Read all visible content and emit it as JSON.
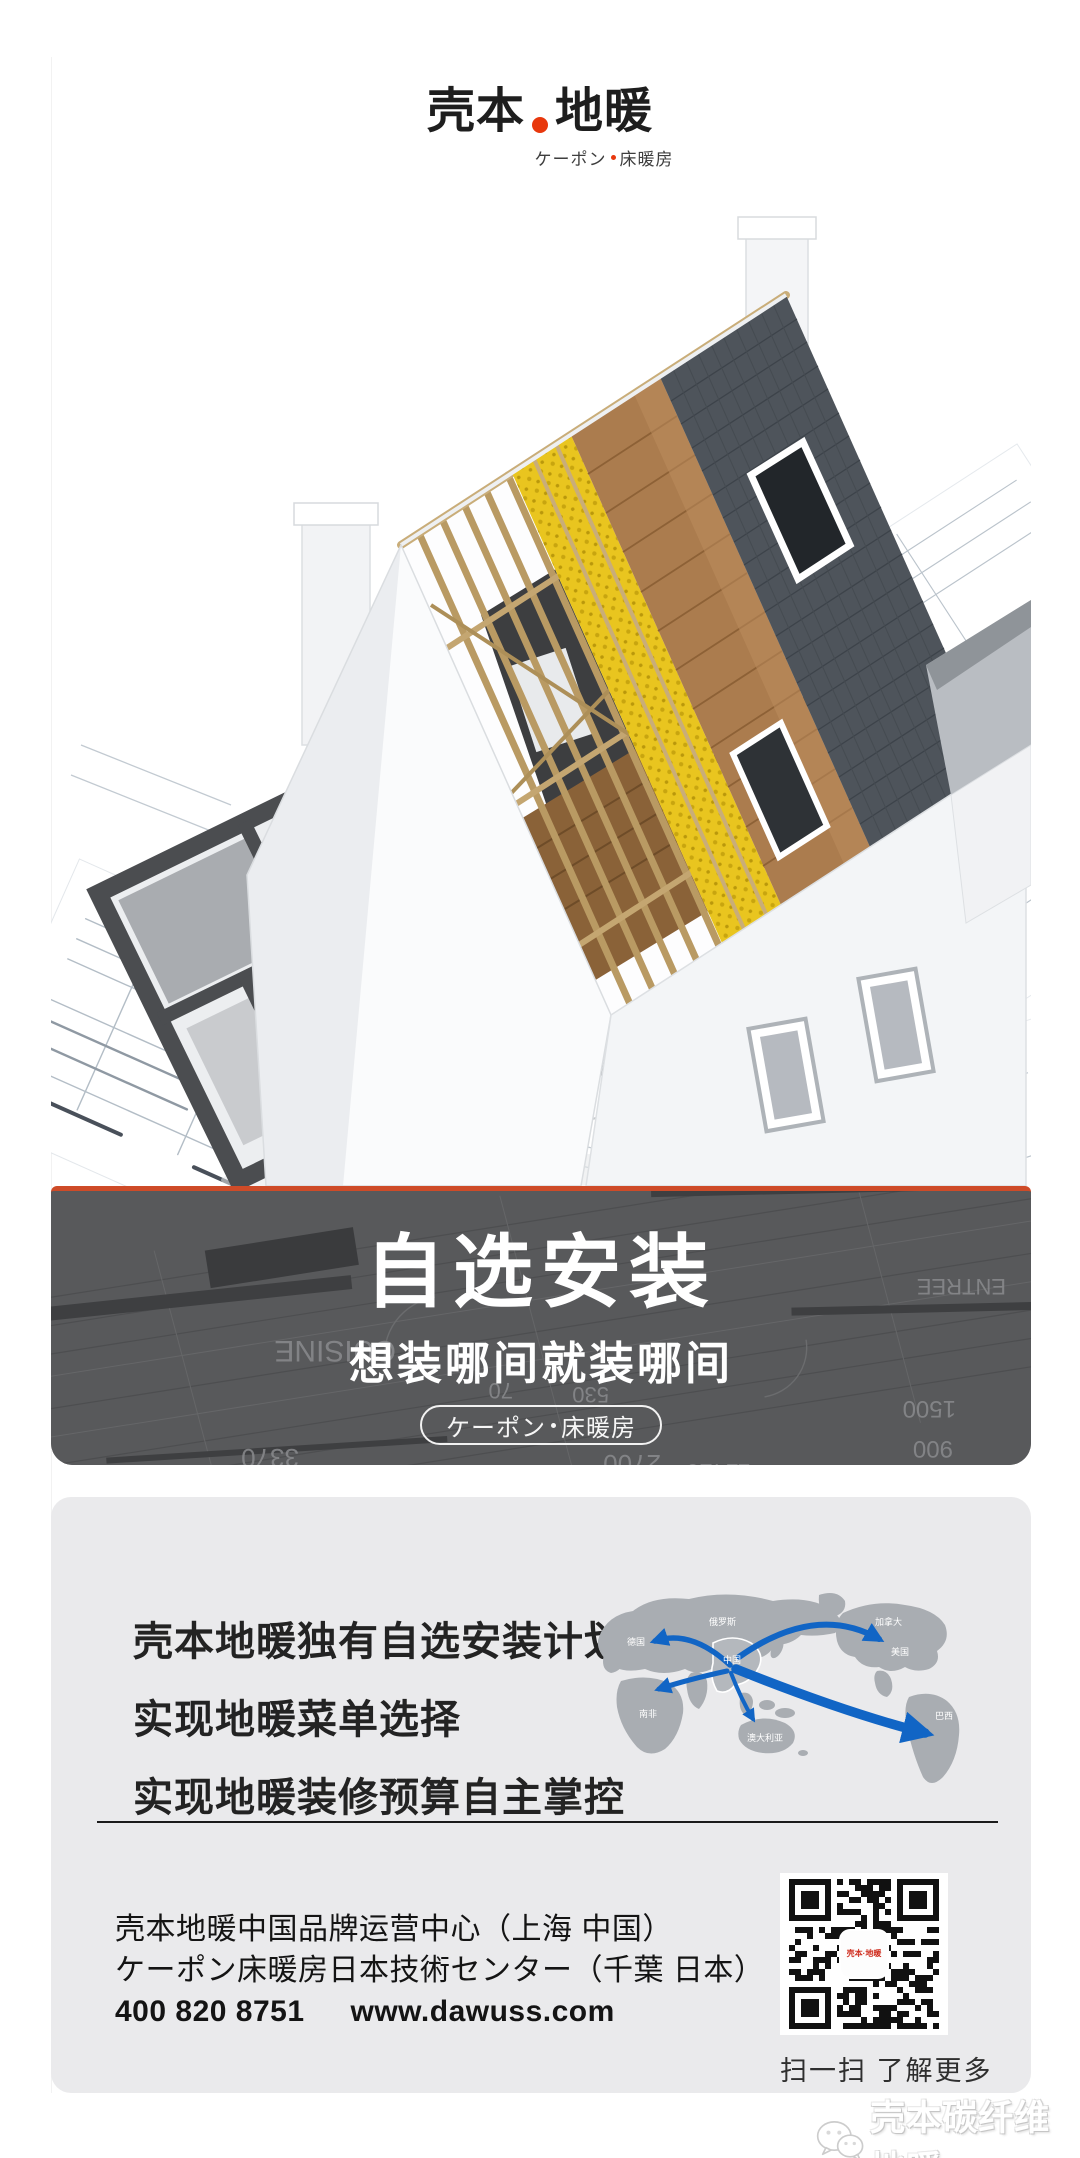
{
  "logo": {
    "title_left": "壳本",
    "title_right": "地暖",
    "subtitle_left": "ケーポン",
    "subtitle_right": "床暖房",
    "accent_color": "#e8380d"
  },
  "banner": {
    "title": "自选安装",
    "subtitle": "想装哪间就装哪间",
    "badge_left": "ケーポン",
    "badge_right": "床暖房",
    "accent_color": "#ce4b28",
    "bg_color": "#58595b",
    "blueprint_words": [
      "CUISINE",
      "ENTREE"
    ],
    "blueprint_numbers": [
      "3370",
      "2700",
      "11420",
      "1500",
      "900",
      "530",
      "70"
    ]
  },
  "hero": {
    "blueprint_words": [
      "TOILET"
    ]
  },
  "info_card": {
    "line1": "壳本地暖独有自选安装计划，",
    "line2": "实现地暖菜单选择",
    "line3": "实现地暖装修预算自主掌控",
    "map": {
      "land_color": "#a9adb2",
      "arrow_color": "#1165c5",
      "labels": [
        {
          "text": "俄罗斯"
        },
        {
          "text": "德国"
        },
        {
          "text": "中国"
        },
        {
          "text": "加拿大"
        },
        {
          "text": "美国"
        },
        {
          "text": "南非"
        },
        {
          "text": "澳大利亚"
        },
        {
          "text": "巴西"
        }
      ]
    }
  },
  "contact": {
    "line1": "壳本地暖中国品牌运营中心（上海 中国）",
    "line2": "ケーポン床暖房日本技術センター（千葉 日本）",
    "phone": "400 820 8751",
    "website": "www.dawuss.com",
    "qr_caption": "扫一扫 了解更多"
  },
  "watermark": {
    "text": "壳本碳纤维地暖"
  }
}
